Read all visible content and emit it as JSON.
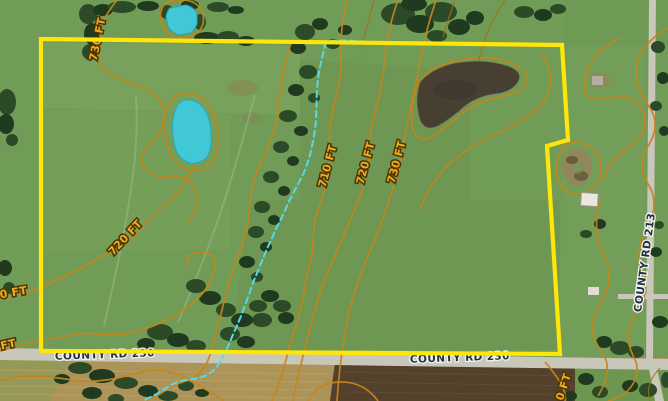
{
  "map": {
    "boundary": {
      "color": "#ffe60a",
      "points": "41,39 562,45 568,140 547,146 560,354 41,351"
    },
    "creek": {
      "color": "#55d9e8",
      "path_main": "M326,42 C322,58 318,72 317,90 C316,106 317,120 314,136 C311,152 309,160 305,170 C300,182 293,192 287,206 C281,220 276,228 273,236 C268,246 264,256 260,266 C256,276 252,284 250,292 C247,300 244,308 241,316 C237,326 233,334 230,342 C227,349 224,354 221,360 C216,370 208,376 198,378 C188,380 178,380 168,387 C158,394 150,397 143,401",
      "path_spur": "M330,41 C344,40 358,41 372,42"
    },
    "contours": {
      "line_color": "#c5851a",
      "label_color": "#f0ac1f",
      "labels": [
        {
          "text": "730 FT"
        },
        {
          "text": "710 FT"
        },
        {
          "text": "720 FT"
        },
        {
          "text": "730 FT"
        },
        {
          "text": "720 FT"
        },
        {
          "text": "0 FT"
        },
        {
          "text": "FT"
        },
        {
          "text": "0 FT"
        }
      ]
    },
    "roads": {
      "surface_color": "#c9c6ba",
      "labels": [
        {
          "text": "COUNTY RD 230"
        },
        {
          "text": "COUNTY RD 230"
        },
        {
          "text": "COUNTY RD 213"
        }
      ]
    },
    "water": {
      "pond_fill": "#41c8d6",
      "dark_pond_fill": "#474032"
    },
    "terrain": {
      "grass": "#719c57",
      "trees": "#2c4a27",
      "plowed_field": "#ac9459",
      "dark_field": "#54412b"
    }
  }
}
